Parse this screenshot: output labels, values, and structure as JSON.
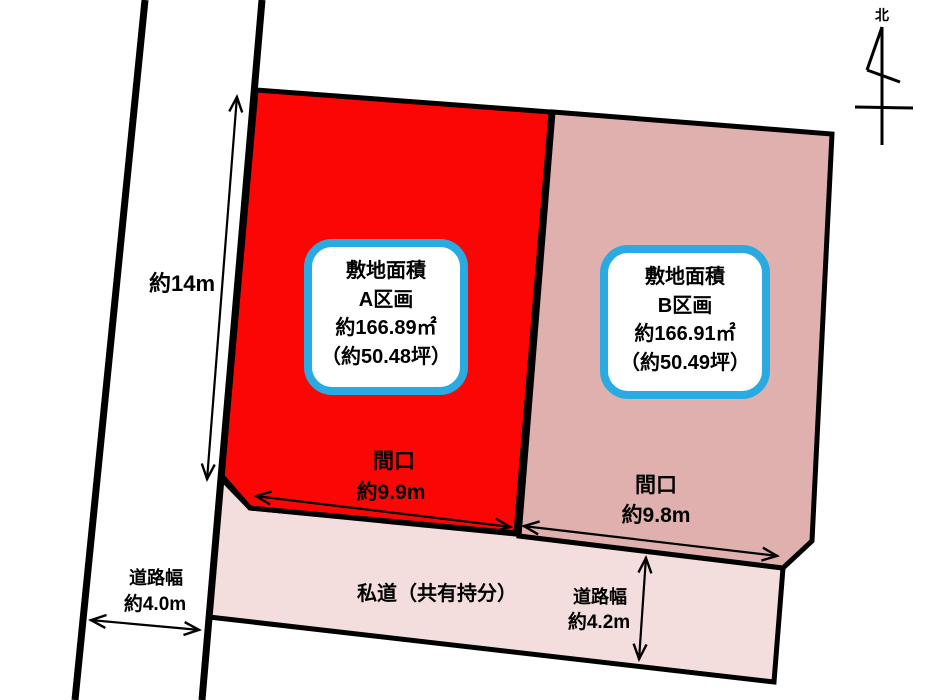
{
  "colors": {
    "parcel_a_fill": "#FB0505",
    "parcel_b_fill": "#DFB0AE",
    "private_road_fill": "#F3DEDD",
    "label_box_border": "#29ABE2",
    "outline": "#000000"
  },
  "north": {
    "label": "北"
  },
  "left_road": {
    "length_label": "約14m",
    "width_label_line1": "道路幅",
    "width_label_line2": "約4.0m"
  },
  "parcel_a": {
    "info_box": {
      "line1": "敷地面積",
      "line2": "A区画",
      "line3": "約166.89㎡",
      "line4": "（約50.48坪）"
    },
    "frontage_line1": "間口",
    "frontage_line2": "約9.9m"
  },
  "parcel_b": {
    "info_box": {
      "line1": "敷地面積",
      "line2": "B区画",
      "line3": "約166.91㎡",
      "line4": "（約50.49坪）"
    },
    "frontage_line1": "間口",
    "frontage_line2": "約9.8m"
  },
  "private_road": {
    "label": "私道（共有持分）",
    "width_label_line1": "道路幅",
    "width_label_line2": "約4.2m"
  }
}
